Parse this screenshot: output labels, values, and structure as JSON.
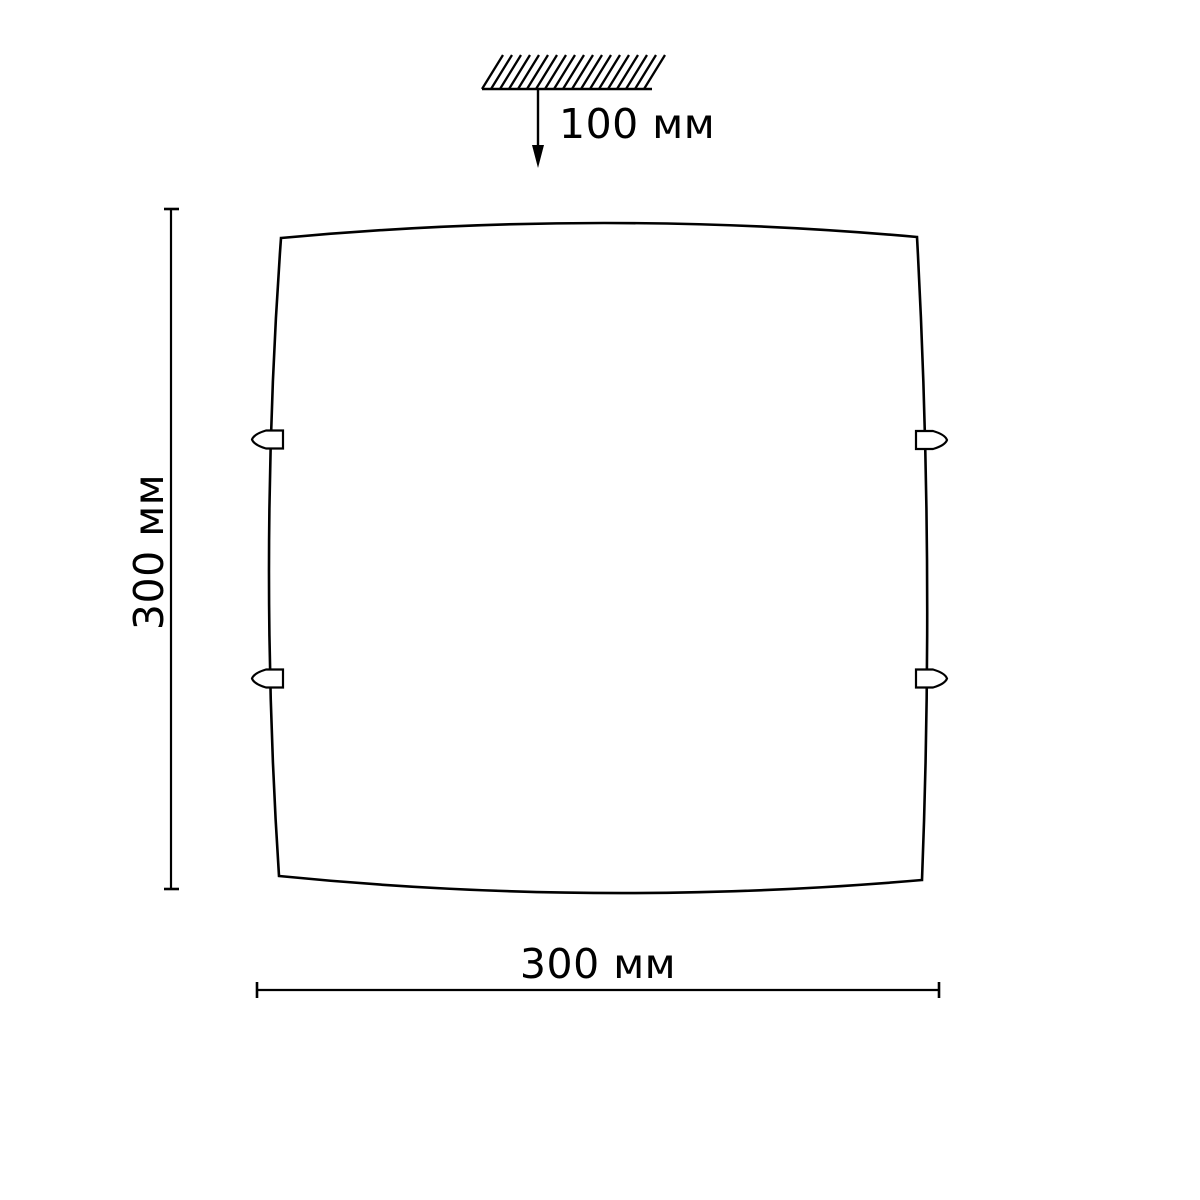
{
  "diagram": {
    "kind": "ceiling-light-dimension-drawing",
    "drop": {
      "label": "100 мм",
      "value": 100,
      "unit": "мм"
    },
    "height": {
      "label": "300 мм",
      "value": 300,
      "unit": "мм"
    },
    "width": {
      "label": "300 мм",
      "value": 300,
      "unit": "мм"
    }
  },
  "icons": {
    "ceiling_symbol": "hatched-ceiling-mount",
    "drop_arrow": "arrow-down",
    "clips": "mounting-clip"
  },
  "colors": {
    "line": "#000000",
    "background": "#ffffff",
    "text": "#000000"
  }
}
